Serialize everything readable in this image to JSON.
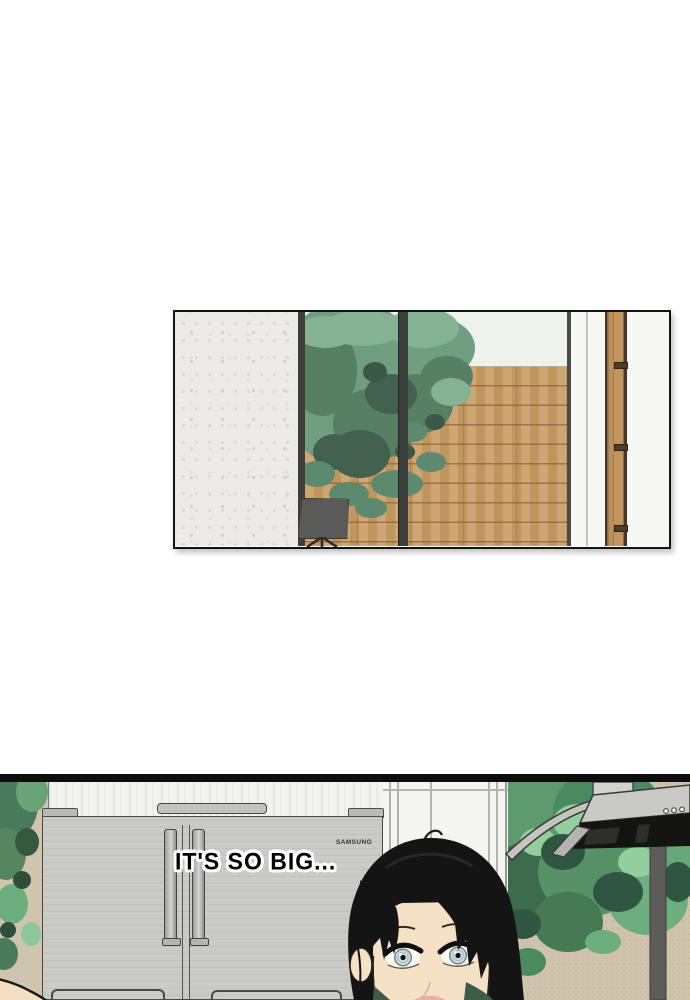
{
  "page": {
    "type": "webtoon comic page",
    "background": "#ffffff"
  },
  "panel_top": {
    "description": "interior with concrete wall, glass door, tree and wood deck"
  },
  "panel_bottom": {
    "speech_text": "IT'S SO BIG...",
    "fridge_brand": "SAMSUNG"
  },
  "colors": {
    "panel_border": "#121212",
    "wood_floor": "#c89c63",
    "foliage_green": "#5d9a6e",
    "foliage_dark": "#2e5640",
    "foliage_light": "#93cf9d",
    "tan_wall": "#cfc3ac",
    "fridge_gray": "#c6c6c3",
    "hair_black": "#141414",
    "skin_tone": "#f5e2c6",
    "eye_iris": "#ccdadb",
    "collar_green": "#3f5c49"
  }
}
